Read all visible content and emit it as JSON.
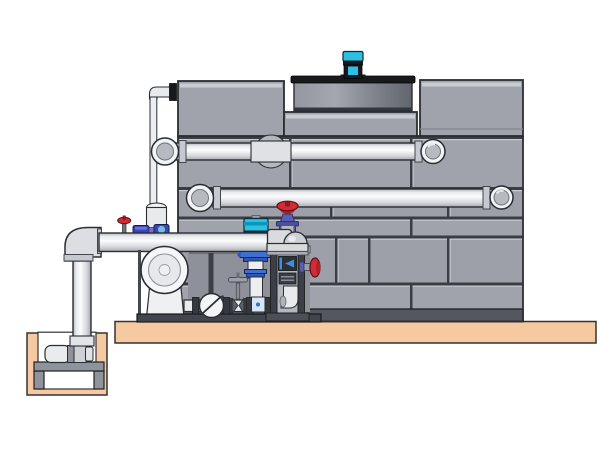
{
  "figure": {
    "type": "technical-illustration",
    "description": "CAD-style side elevation of a factory-assembled cooling tower: panelled casing with axial fan shroud and cyan fan motor on top, two horizontal supply/return pipes entering the casing, a pump skid with end-suction pump, vertical turbine pump with cyan motor, red-handwheel globe valve on the header elbow, check valve and gate valve on the low pipe run, chemical-feed mini valves, a vent line to the casing, and a riser pipe dropping into a below-grade sump pit with a horizontal sump pump, all mounted on a tan concrete base slab.",
    "background": "#ffffff",
    "visible_text": []
  },
  "colors": {
    "outline": "#2a2d33",
    "panel": "#a0a3ab",
    "panel_seam": "#3a3d44",
    "panel_highlight": "#c9ccd3",
    "tower_strip": "#54575e",
    "slab": "#f6c9a1",
    "motor_cyan": "#2bc0e4",
    "rim_black": "#17191d",
    "valve_red": "#d32b35",
    "valve_purple": "#5a5fae",
    "valve_blue": "#3a44b4",
    "pump_blue": "#3f6fd1",
    "stand_frame": "#3c3f45",
    "backdrop": "#8e919a",
    "metal_white": "#f4f5f6",
    "metal_mid": "#c6c9cf",
    "pipe_light": "#eceef0"
  },
  "components": [
    {
      "name": "cooling-tower-casing",
      "desc": "grey brick-pattern panel casing"
    },
    {
      "name": "fan-shroud",
      "desc": "cylindrical fan shroud with black rim"
    },
    {
      "name": "fan-motor",
      "desc": "cyan and black motor on shroud"
    },
    {
      "name": "upper-supply-pipe",
      "desc": "horizontal pipe with viewer-facing elbows"
    },
    {
      "name": "lower-supply-pipe",
      "desc": "horizontal pipe with viewer-facing elbows"
    },
    {
      "name": "pump-header-pipe",
      "desc": "foreground header from riser to stand elbow"
    },
    {
      "name": "riser-pipe",
      "desc": "vertical pipe dropping into sump pit"
    },
    {
      "name": "sump-pit",
      "desc": "tan concrete pit below grade"
    },
    {
      "name": "sump-pump",
      "desc": "horizontal pump on stand inside pit"
    },
    {
      "name": "end-suction-pump",
      "desc": "white volute pump on skid"
    },
    {
      "name": "vertical-turbine-pump",
      "desc": "cyan motor, blue discharge head, white column"
    },
    {
      "name": "globe-valve-red-handwheel",
      "desc": "purple body valve atop header elbow"
    },
    {
      "name": "side-red-handwheel-valve",
      "desc": "red handwheel valve off pipe stand"
    },
    {
      "name": "chemical-feed-valves",
      "desc": "small red and blue valves on header"
    },
    {
      "name": "check-valve",
      "desc": "circular swing check on low pipe run"
    },
    {
      "name": "gate-valve",
      "desc": "bow-tie gate valve with tee handle"
    },
    {
      "name": "pipe-stand",
      "desc": "framed support column with gauge module"
    },
    {
      "name": "vent-line",
      "desc": "thin pipe from casing top to standpipe"
    },
    {
      "name": "concrete-slab",
      "desc": "tan foundation slab"
    }
  ]
}
